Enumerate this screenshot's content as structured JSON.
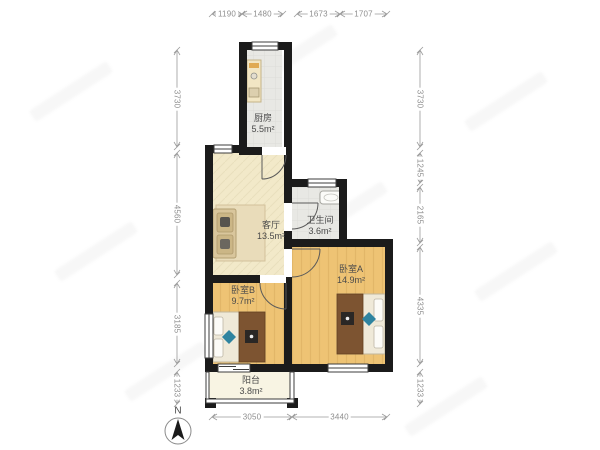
{
  "rooms": {
    "kitchen": {
      "name": "厨房",
      "area": "5.5m²"
    },
    "living": {
      "name": "客厅",
      "area": "13.5m²"
    },
    "bathroom": {
      "name": "卫生间",
      "area": "3.6m²"
    },
    "bedroomA": {
      "name": "卧室A",
      "area": "14.9m²"
    },
    "bedroomB": {
      "name": "卧室B",
      "area": "9.7m²"
    },
    "balcony": {
      "name": "阳台",
      "area": "3.8m²"
    }
  },
  "dims": {
    "top": [
      "1190",
      "1480",
      "1673",
      "1707"
    ],
    "left": [
      "3730",
      "4560",
      "3185",
      "1233"
    ],
    "right": [
      "3730",
      "1245",
      "2165",
      "4335",
      "1233"
    ],
    "bottom": [
      "3050",
      "3440"
    ]
  },
  "compass": {
    "north_label": "N"
  },
  "colors": {
    "wall": "#1b1b1b",
    "wood-floor": "#eec374",
    "cream-floor": "#f2e9c9",
    "tile-floor": "#e8e8e4",
    "balcony-floor": "#f8f4e3",
    "duvet": "#7d5431",
    "accent-teal": "#2f84a0",
    "dim-text": "#8e8e8e",
    "label-text": "#4b4b4b"
  }
}
